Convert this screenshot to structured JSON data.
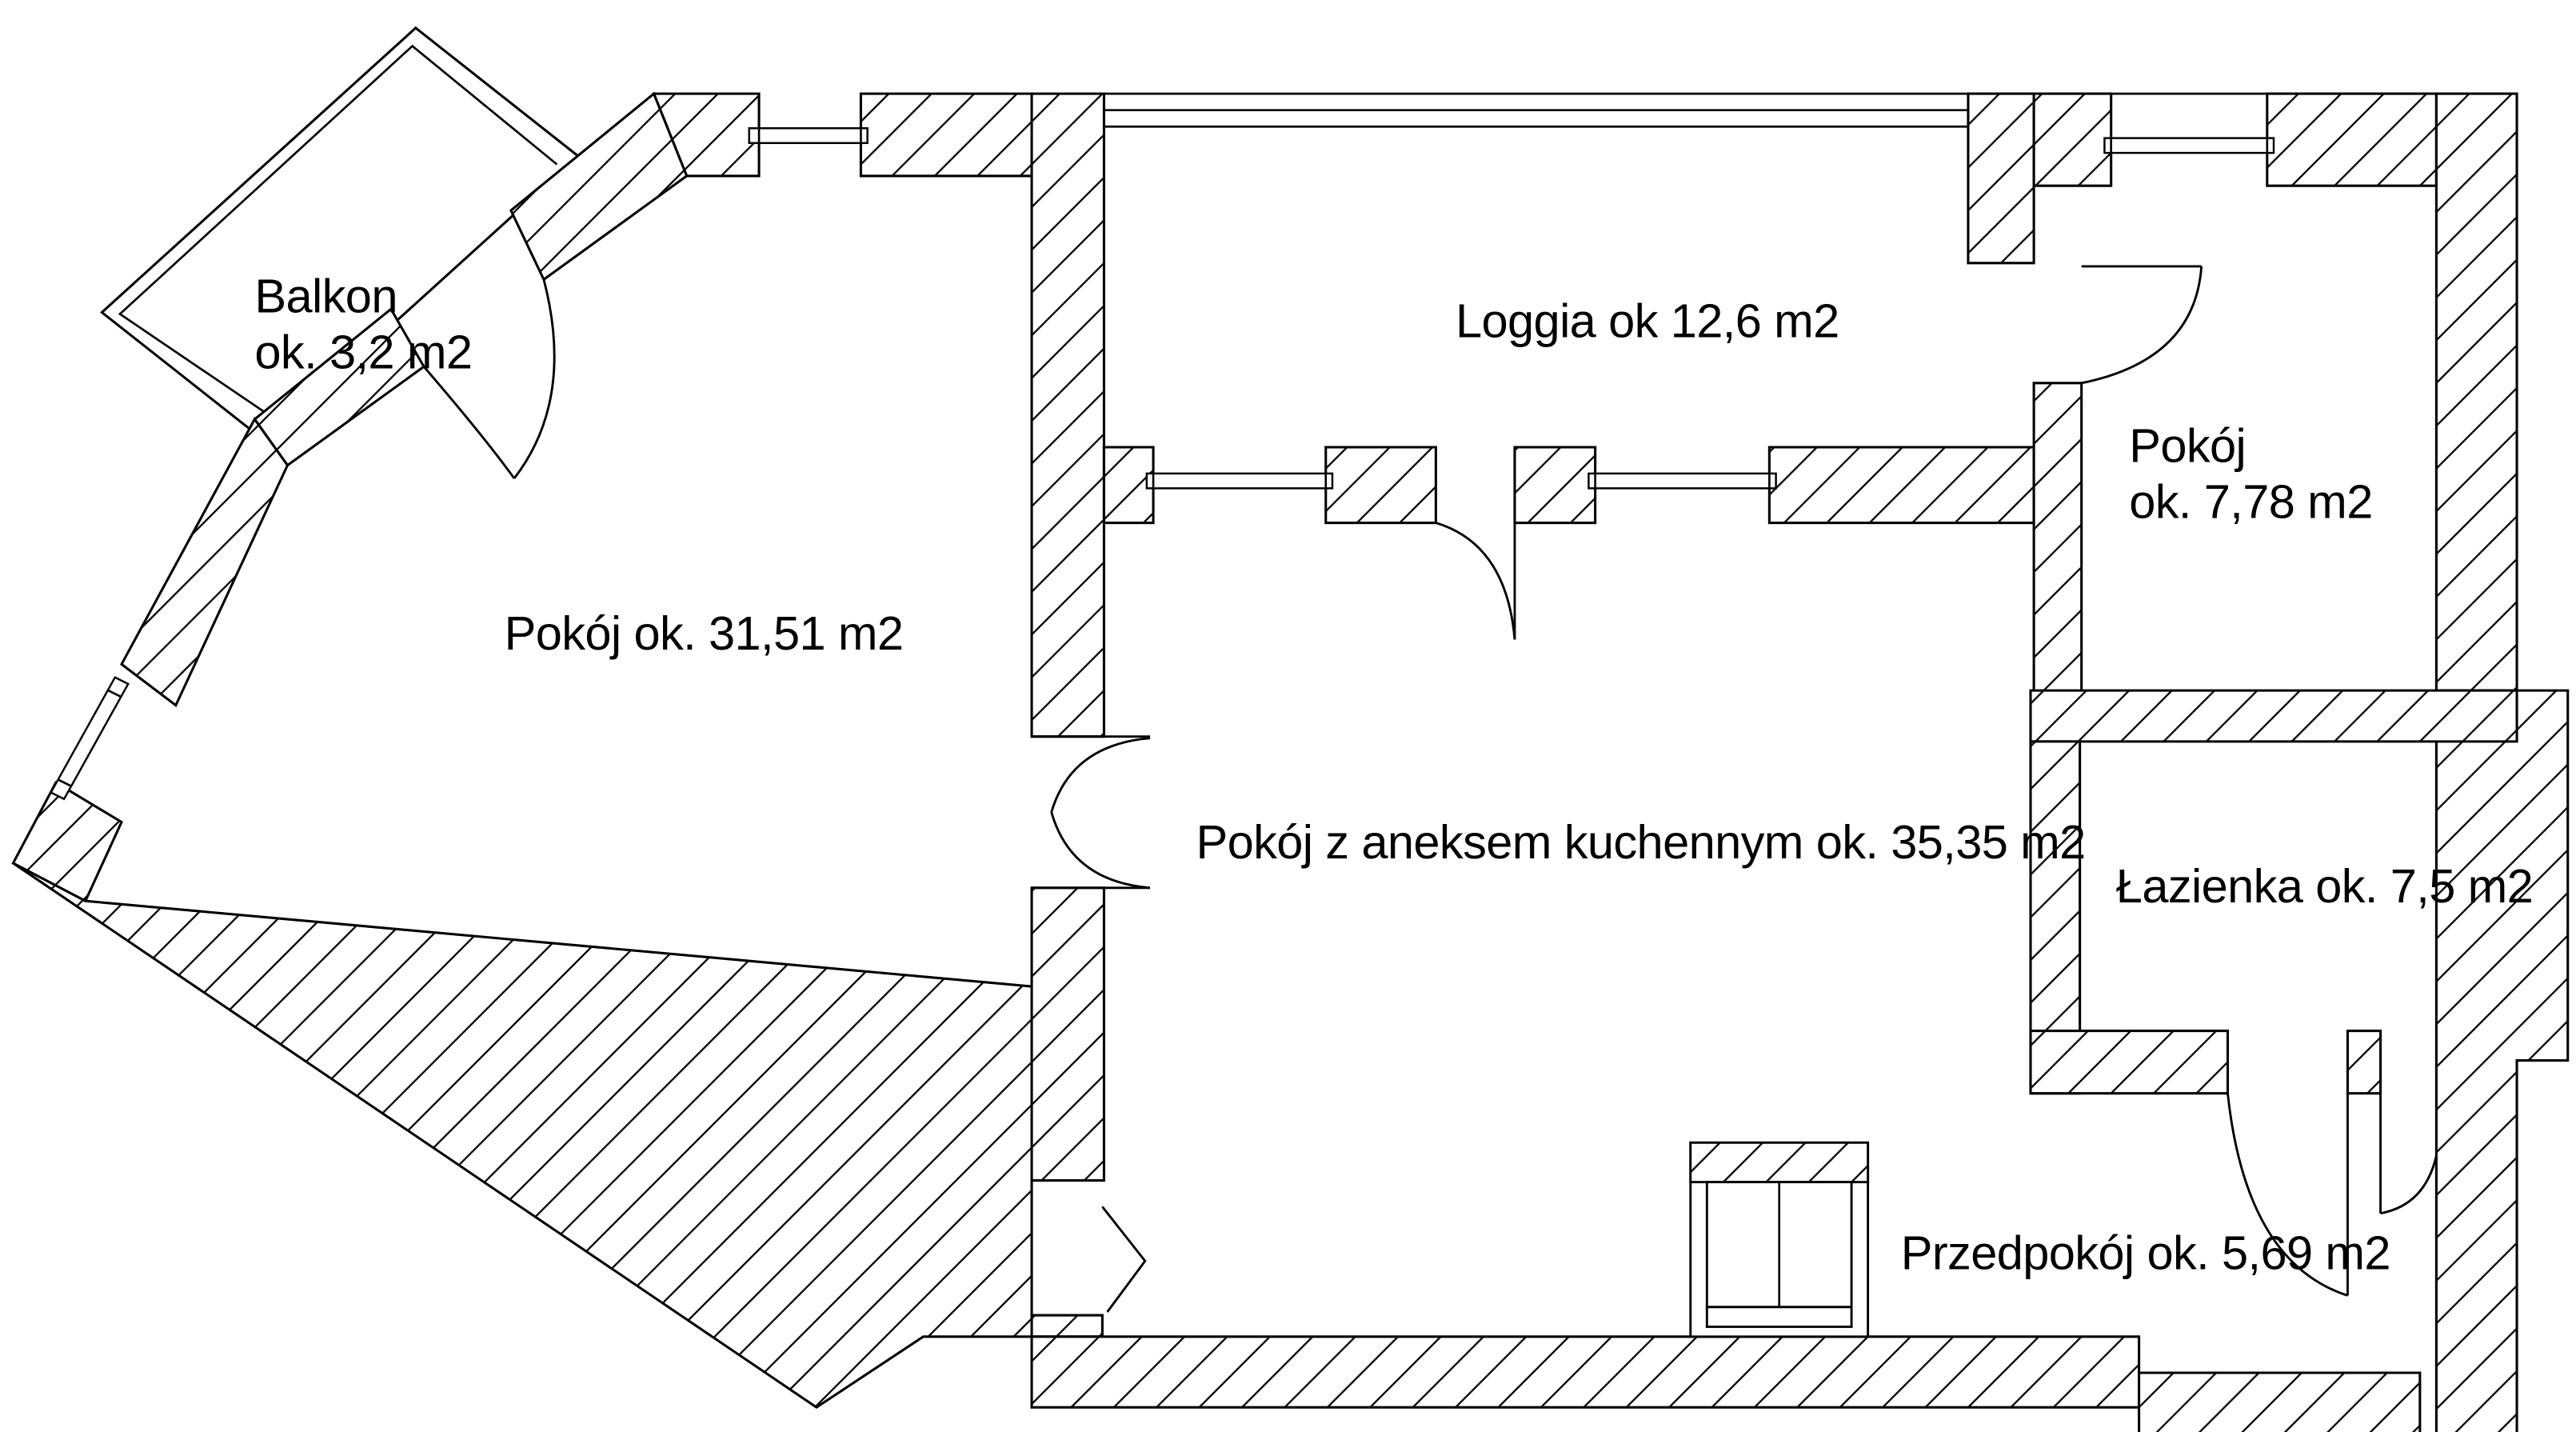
{
  "floor_plan": {
    "type": "apartment-floor-plan",
    "colors": {
      "line": "#000000",
      "background": "#ffffff"
    },
    "rooms": {
      "balkon": {
        "line1": "Balkon",
        "line2": "ok. 3,2 m2"
      },
      "loggia": {
        "label": "Loggia ok 12,6 m2"
      },
      "pokoj_duzy": {
        "label": "Pokój ok. 31,51 m2"
      },
      "pokoj_maly": {
        "line1": "Pokój",
        "line2": "ok. 7,78 m2"
      },
      "pokoj_aneks": {
        "label": "Pokój z aneksem kuchennym ok. 35,35 m2"
      },
      "lazienka": {
        "label": "Łazienka ok. 7,5 m2"
      },
      "przedpokoj": {
        "label": "Przedpokój ok. 5,69 m2"
      }
    }
  }
}
